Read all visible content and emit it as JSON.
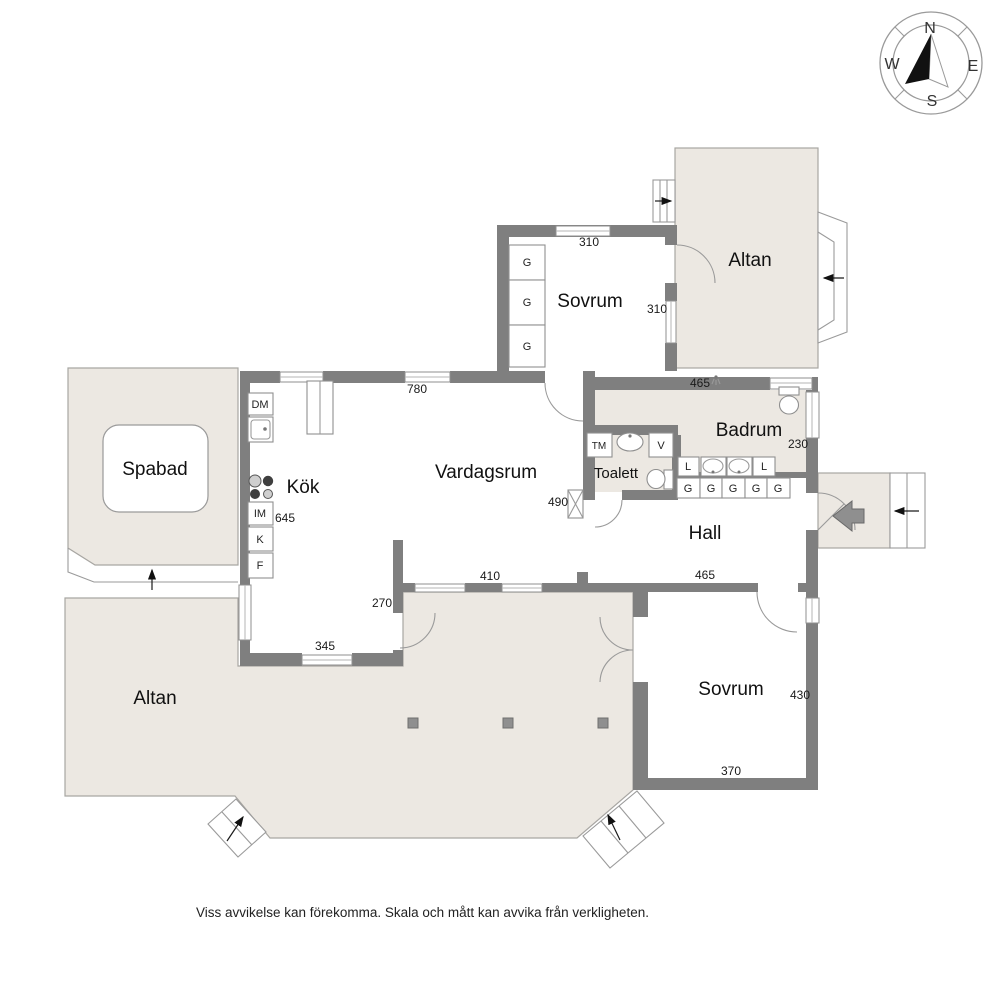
{
  "compass": {
    "n": "N",
    "e": "E",
    "s": "S",
    "w": "W"
  },
  "rooms": {
    "sovrum_top": "Sovrum",
    "altan_top": "Altan",
    "badrum": "Badrum",
    "toalett": "Toalett",
    "hall": "Hall",
    "vardagsrum": "Vardagsrum",
    "kok": "Kök",
    "spabad": "Spabad",
    "altan_bottom": "Altan",
    "sovrum_bottom": "Sovrum"
  },
  "dimensions": {
    "sovrum_top_w": "310",
    "sovrum_top_d": "310",
    "vardagsrum_n": "780",
    "badrum_w": "465",
    "badrum_d": "230",
    "vardagsrum_e": "490",
    "kok_d": "645",
    "hall_w": "465",
    "vardagsrum_s": "410",
    "kok_se": "270",
    "kok_s": "345",
    "sovrum_bottom_d": "430",
    "sovrum_bottom_w": "370"
  },
  "fixtures": {
    "wardrobe": "G",
    "linen": "L",
    "dishwasher": "DM",
    "washing_machine": "TM",
    "water_heater": "V",
    "microwave": "IM",
    "fridge": "K",
    "freezer": "F"
  },
  "footer": {
    "disclaimer": "Viss avvikelse kan förekomma. Skala och mått kan avvika från verkligheten."
  },
  "colors": {
    "wall": "#7f7f7f",
    "deck_fill": "#ece8e2",
    "deck_outline": "#a8a6a2",
    "background": "#ffffff"
  }
}
